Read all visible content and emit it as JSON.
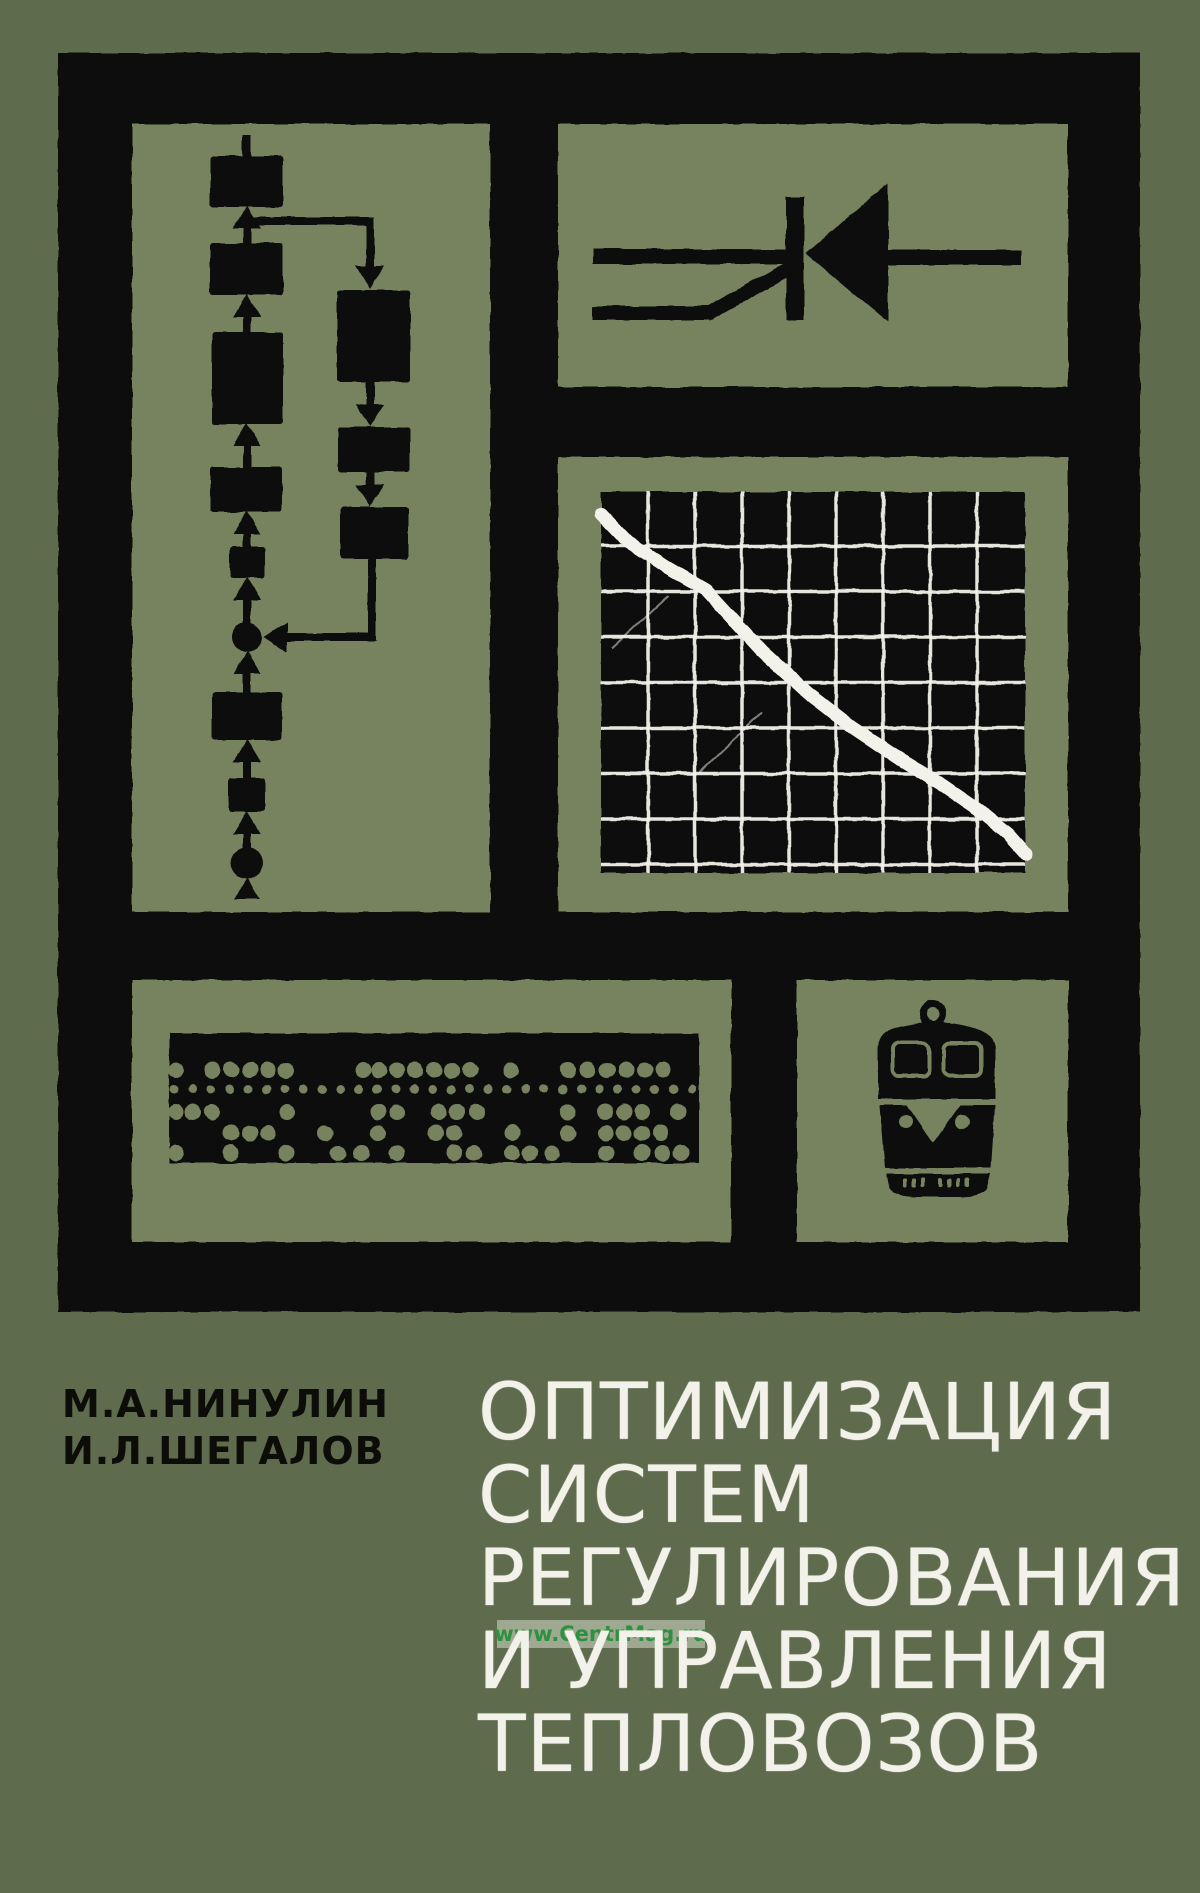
{
  "cover_type": "scanned-book-cover",
  "colors": {
    "bg": "#5e6b4c",
    "panel": "#77825e",
    "ink": "#0c0c09",
    "paper": "#f2f1ea",
    "wm_text": "#2e9140",
    "wm_box": "rgba(214,219,202,0.55)"
  },
  "authors": {
    "line1": "М.А.НИНУЛИН",
    "line2": "И.Л.ШЕГАЛОВ"
  },
  "title": {
    "lines": [
      "ОПТИМИЗАЦИЯ",
      "СИСТЕМ",
      "РЕГУЛИРОВАНИЯ",
      "И УПРАВЛЕНИЯ",
      "ТЕПЛОВОЗОВ"
    ]
  },
  "watermark": {
    "text": "www.CentrMag.ru"
  },
  "icons": {
    "flowchart": "program-flowchart",
    "thyristor": "thyristor-circuit-symbol",
    "oscilloscope": "crt-screen-decaying-curve",
    "punched_tape": "punched-paper-tape",
    "locomotive": "diesel-locomotive-front"
  },
  "artwork": {
    "oscilloscope": {
      "screen": {
        "x": 601,
        "y": 492,
        "w": 424,
        "h": 381
      },
      "grid": {
        "x0": 648,
        "dx": 47,
        "cols": 8,
        "y0": 546,
        "dy": 45.5,
        "rows": 8
      },
      "curve_points": [
        [
          601,
          514
        ],
        [
          628,
          542
        ],
        [
          668,
          568
        ],
        [
          706,
          590
        ],
        [
          716,
          601
        ],
        [
          762,
          651
        ],
        [
          808,
          693
        ],
        [
          852,
          727
        ],
        [
          898,
          758
        ],
        [
          942,
          785
        ],
        [
          980,
          811
        ],
        [
          1008,
          834
        ],
        [
          1026,
          854
        ]
      ],
      "artifact_lines": [
        [
          612,
          648,
          668,
          596
        ],
        [
          700,
          772,
          762,
          712
        ]
      ]
    },
    "punched_tape": {
      "rect": {
        "x": 169,
        "y": 1033,
        "w": 530,
        "h": 130
      },
      "rows": [
        {
          "y": 1070,
          "d": 16,
          "x": [
            176,
            212,
            231,
            250,
            268,
            286,
            363,
            379,
            397,
            415,
            434,
            452,
            470,
            511,
            568,
            588,
            607,
            626,
            645,
            663
          ]
        },
        {
          "y": 1089,
          "d": 9,
          "start": 174,
          "step": 18.5,
          "count": 29
        },
        {
          "y": 1112,
          "d": 16,
          "x": [
            176,
            193,
            212,
            287,
            378,
            397,
            439,
            457,
            477,
            568,
            605,
            624,
            642,
            678
          ]
        },
        {
          "y": 1133,
          "d": 16,
          "x": [
            231,
            250,
            268,
            325,
            378,
            436,
            454,
            512,
            568,
            606,
            624,
            642,
            661
          ]
        },
        {
          "y": 1153,
          "d": 16,
          "x": [
            176,
            231,
            286,
            338,
            361,
            397,
            454,
            474,
            512,
            530,
            552,
            606,
            642,
            662,
            681
          ]
        }
      ]
    },
    "locomotive": {
      "grille_ticks": {
        "y": 1178,
        "w": 4,
        "h": 9,
        "x": [
          903,
          912,
          921,
          938,
          947,
          956,
          965
        ]
      }
    }
  }
}
